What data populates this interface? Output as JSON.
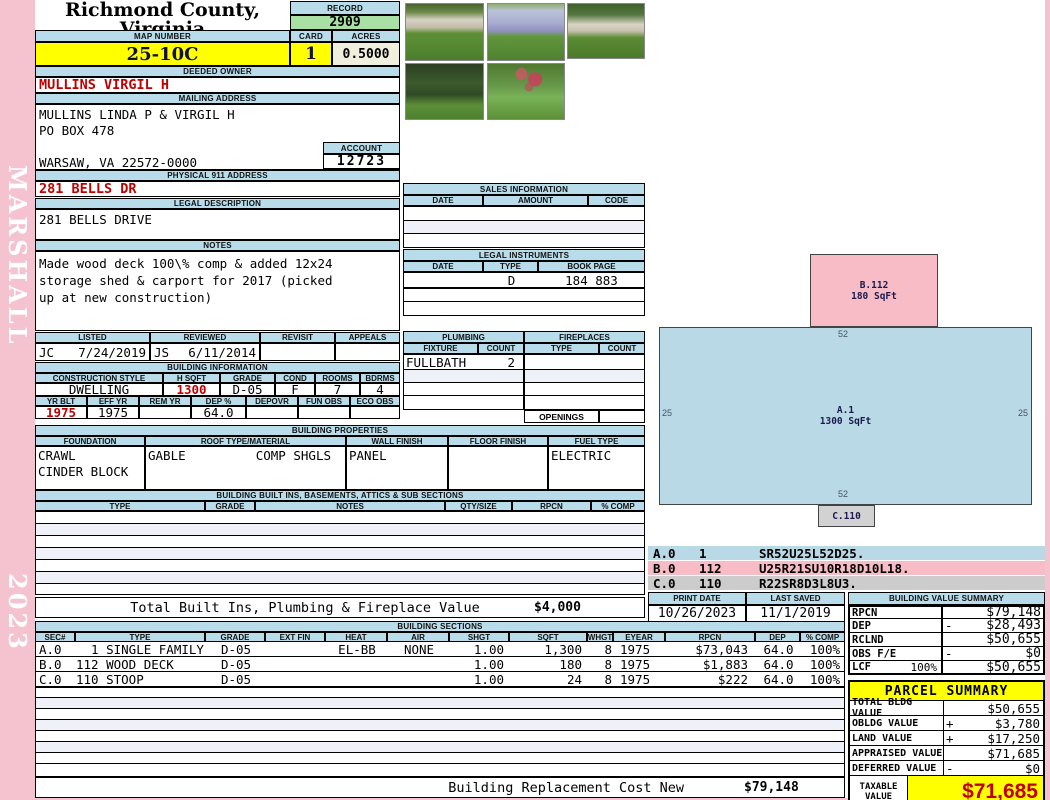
{
  "colors": {
    "header_blue": "#b9dcea",
    "record_green": "#a9e1a4",
    "highlight_yellow": "#ffff00",
    "cream": "#f0eedc",
    "accent_red": "#c00000",
    "page_pink": "#f5c2d0",
    "sketch_blue": "#b9d9e6",
    "sketch_pink": "#f7bcc6",
    "sketch_gray": "#d2d2d2"
  },
  "sidebar": {
    "district": "MARSHALL",
    "year": "2023"
  },
  "header": {
    "county": "Richmond County, Virginia",
    "commissioner": "Commissioner of the Revenue, PO Box 366, Warsaw, VA 22572",
    "record_label": "RECORD",
    "record": "2909",
    "map_label": "MAP NUMBER",
    "map_number": "25-10C",
    "card_label": "CARD",
    "card": "1",
    "acres_label": "ACRES",
    "acres": "0.5000"
  },
  "owner": {
    "deeded_label": "DEEDED OWNER",
    "deeded": "MULLINS VIRGIL H",
    "mailing_label": "MAILING ADDRESS",
    "mailing_lines": [
      "MULLINS LINDA P & VIRGIL H",
      "PO BOX 478",
      "",
      "WARSAW, VA 22572-0000"
    ],
    "account_label": "ACCOUNT",
    "account": "12723",
    "physical_label": "PHYSICAL 911 ADDRESS",
    "physical": "281 BELLS DR"
  },
  "legal": {
    "label": "LEGAL DESCRIPTION",
    "text": "281 BELLS DRIVE"
  },
  "notes": {
    "label": "NOTES",
    "lines": [
      "Made wood deck 100\\% comp & added 12x24",
      "storage shed & carport for 2017 (picked",
      "up at new construction)"
    ]
  },
  "review": {
    "listed_label": "LISTED",
    "listed_by": "JC",
    "listed_date": "7/24/2019",
    "reviewed_label": "REVIEWED",
    "reviewed_by": "JS",
    "reviewed_date": "6/11/2014",
    "revisit_label": "REVISIT",
    "appeals_label": "APPEALS"
  },
  "building_info": {
    "title": "BUILDING INFORMATION",
    "style_label": "CONSTRUCTION STYLE",
    "style": "DWELLING",
    "hsqft_label": "H SQFT",
    "hsqft": "1300",
    "grade_label": "GRADE",
    "grade": "D-05",
    "cond_label": "COND",
    "cond": "F",
    "rooms_label": "ROOMS",
    "rooms": "7",
    "bdrms_label": "BDRMS",
    "bdrms": "4",
    "yrblt_label": "YR BLT",
    "yrblt": "1975",
    "effyr_label": "EFF YR",
    "effyr": "1975",
    "remyr_label": "REM YR",
    "remyr": "",
    "dep_label": "DEP %",
    "dep": "64.0",
    "depovr_label": "DEPOVR",
    "depovr": "",
    "funobs_label": "FUN OBS",
    "funobs": "",
    "ecoobs_label": "ECO OBS",
    "ecoobs": ""
  },
  "properties": {
    "title": "BUILDING PROPERTIES",
    "columns": [
      "FOUNDATION",
      "ROOF TYPE/MATERIAL",
      "WALL FINISH",
      "FLOOR FINISH",
      "FUEL TYPE"
    ],
    "foundation_line1": "CRAWL",
    "foundation_line2": "CINDER BLOCK",
    "roof_type": "GABLE",
    "roof_material": "COMP SHGLS",
    "wall": "PANEL",
    "floor": "",
    "fuel": "ELECTRIC"
  },
  "builtins": {
    "title": "BUILDING BUILT INS, BASEMENTS, ATTICS & SUB SECTIONS",
    "columns": [
      "TYPE",
      "GRADE",
      "NOTES",
      "QTY/SIZE",
      "RPCN",
      "% COMP"
    ],
    "total_label": "Total Built Ins, Plumbing & Fireplace Value",
    "total": "$4,000"
  },
  "sales": {
    "title": "SALES INFORMATION",
    "columns": [
      "DATE",
      "AMOUNT",
      "CODE"
    ]
  },
  "instruments": {
    "title": "LEGAL INSTRUMENTS",
    "columns": [
      "DATE",
      "TYPE",
      "BOOK PAGE"
    ],
    "rows": [
      {
        "date": "",
        "type": "D",
        "book_page": "184 883"
      }
    ]
  },
  "plumbing": {
    "title": "PLUMBING",
    "fixture_label": "FIXTURE",
    "count_label": "COUNT",
    "rows": [
      {
        "fixture": "FULLBATH",
        "count": "2"
      }
    ]
  },
  "fireplaces": {
    "title": "FIREPLACES",
    "type_label": "TYPE",
    "count_label": "COUNT",
    "openings_label": "OPENINGS"
  },
  "sketch": {
    "shapes": [
      {
        "id": "A.1",
        "sqft": "1300 SqFt",
        "dim_top": "52",
        "dim_bottom": "52",
        "dim_left": "25",
        "dim_right": "25"
      },
      {
        "id": "B.112",
        "sqft": "180 SqFt"
      },
      {
        "id": "C.110"
      }
    ],
    "legend": [
      {
        "sec": "A.0",
        "code": "1",
        "trace": "SR52U25L52D25."
      },
      {
        "sec": "B.0",
        "code": "112",
        "trace": "U25R21SU10R18D10L18."
      },
      {
        "sec": "C.0",
        "code": "110",
        "trace": "R22SR8D3L8U3."
      }
    ]
  },
  "dates": {
    "print_label": "PRINT DATE",
    "print": "10/26/2023",
    "saved_label": "LAST SAVED",
    "saved": "11/1/2019"
  },
  "value_summary": {
    "title": "BUILDING VALUE SUMMARY",
    "rows": [
      {
        "label": "RPCN",
        "sign": "",
        "extra": "",
        "value": "$79,148"
      },
      {
        "label": "DEP",
        "sign": "-",
        "extra": "",
        "value": "$28,493"
      },
      {
        "label": "RCLND",
        "sign": "",
        "extra": "",
        "value": "$50,655"
      },
      {
        "label": "OBS F/E",
        "sign": "-",
        "extra": "",
        "value": "$0"
      },
      {
        "label": "LCF",
        "sign": "",
        "extra": "100%",
        "value": "$50,655"
      }
    ]
  },
  "sections": {
    "title": "BUILDING SECTIONS",
    "columns": [
      "SEC#",
      "TYPE",
      "GRADE",
      "EXT FIN",
      "HEAT",
      "AIR",
      "SHGT",
      "SQFT",
      "WHGT",
      "EYEAR",
      "RPCN",
      "DEP",
      "% COMP"
    ],
    "rows": [
      {
        "sec": "A.0",
        "type": "  1 SINGLE FAMILY",
        "grade": "D-05",
        "extfin": "",
        "heat": "EL-BB",
        "air": "NONE",
        "shgt": "1.00",
        "sqft": "1,300",
        "whgt": "8",
        "eyear": "1975",
        "rpcn": "$73,043",
        "dep": "64.0",
        "comp": "100%"
      },
      {
        "sec": "B.0",
        "type": "112 WOOD DECK",
        "grade": "D-05",
        "extfin": "",
        "heat": "",
        "air": "",
        "shgt": "1.00",
        "sqft": "180",
        "whgt": "8",
        "eyear": "1975",
        "rpcn": "$1,883",
        "dep": "64.0",
        "comp": "100%"
      },
      {
        "sec": "C.0",
        "type": "110 STOOP",
        "grade": "D-05",
        "extfin": "",
        "heat": "",
        "air": "",
        "shgt": "1.00",
        "sqft": "24",
        "whgt": "8",
        "eyear": "1975",
        "rpcn": "$222",
        "dep": "64.0",
        "comp": "100%"
      }
    ]
  },
  "replacement": {
    "label": "Building Replacement Cost New",
    "value": "$79,148"
  },
  "parcel": {
    "title": "PARCEL SUMMARY",
    "rows": [
      {
        "label": "TOTAL BLDG VALUE",
        "sign": "",
        "value": "$50,655"
      },
      {
        "label": "OBLDG VALUE",
        "sign": "+",
        "value": "$3,780"
      },
      {
        "label": "LAND VALUE",
        "sign": "+",
        "value": "$17,250"
      },
      {
        "label": "APPRAISED VALUE",
        "sign": "",
        "value": "$71,685"
      },
      {
        "label": "DEFERRED VALUE",
        "sign": "-",
        "value": "$0"
      }
    ],
    "taxable_label_line1": "TAXABLE",
    "taxable_label_line2": "VALUE",
    "taxable": "$71,685"
  }
}
